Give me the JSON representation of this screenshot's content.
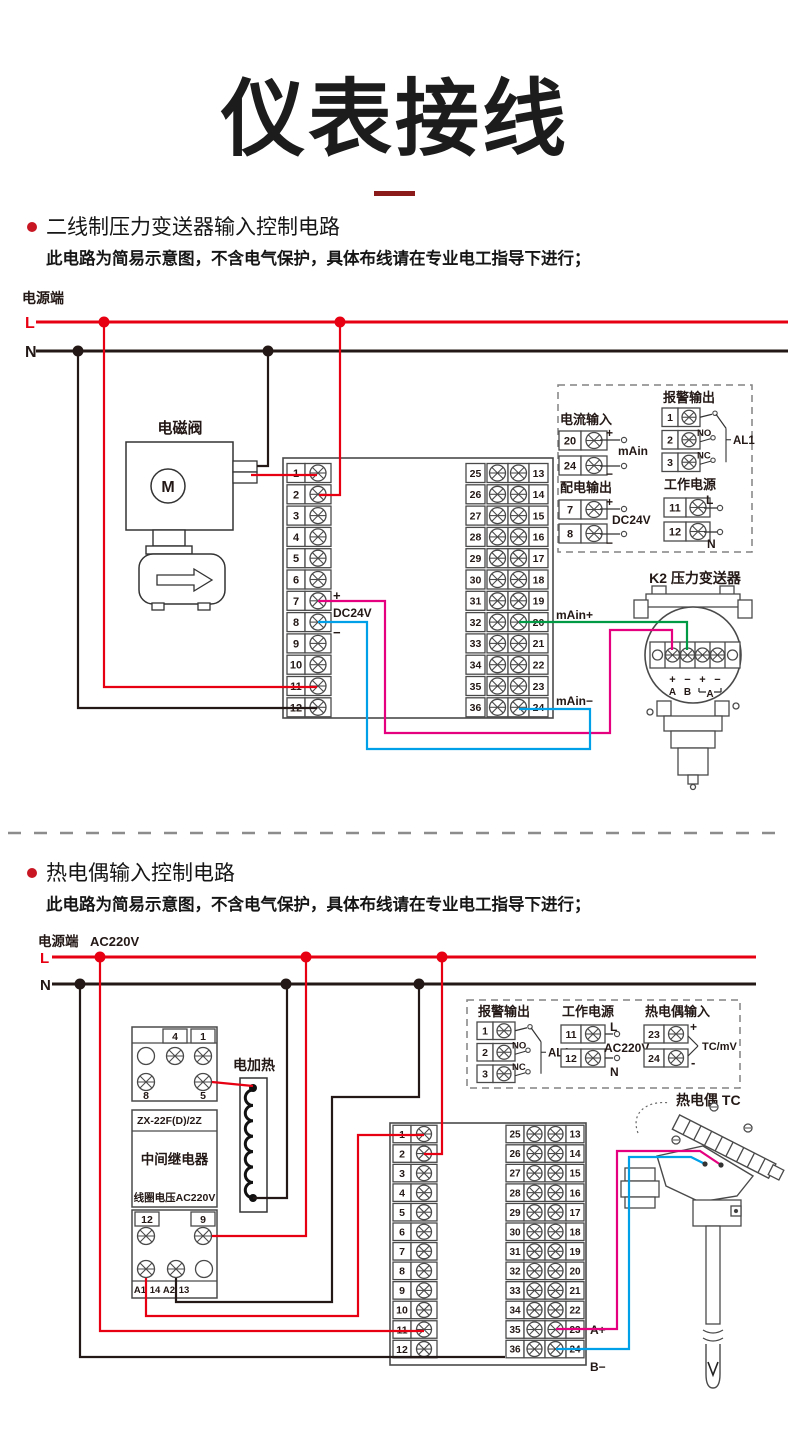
{
  "page": {
    "title": "仪表接线"
  },
  "colors": {
    "accent": "#8b1a1a",
    "bullet": "#c81623",
    "red": "#e60012",
    "black": "#231815",
    "magenta": "#e4007f",
    "blue": "#00a0e9",
    "green": "#009944",
    "gray": "#595757",
    "dash": "#8c8c8c"
  },
  "sections": [
    {
      "heading": "二线制压力变送器输入控制电路",
      "note": "此电路为简易示意图，不含电气保护，具体布线请在专业电工指导下进行；"
    },
    {
      "heading": "热电偶输入控制电路",
      "note": "此电路为简易示意图，不含电气保护，具体布线请在专业电工指导下进行；"
    }
  ],
  "diagram1": {
    "power_label": "电源端",
    "l": "L",
    "n": "N",
    "solenoid": {
      "label": "电磁阀",
      "motor": "M"
    },
    "block": {
      "left": [
        "1",
        "2",
        "3",
        "4",
        "5",
        "6",
        "7",
        "8",
        "9",
        "10",
        "11",
        "12"
      ],
      "mid": [
        "25",
        "26",
        "27",
        "28",
        "29",
        "30",
        "31",
        "32",
        "33",
        "34",
        "35",
        "36"
      ],
      "right": [
        "13",
        "14",
        "15",
        "16",
        "17",
        "18",
        "19",
        "20",
        "21",
        "22",
        "23",
        "24"
      ]
    },
    "block_labels": {
      "plus": "+",
      "dc24v": "DC24V",
      "minus": "−",
      "main_plus": "mAin+",
      "main_minus": "mAin−"
    },
    "legend": {
      "current_input": {
        "title": "电流输入",
        "terminals": [
          "20",
          "24"
        ],
        "plus": "+",
        "minus": "−",
        "label": "mAin"
      },
      "alarm_output": {
        "title": "报警输出",
        "terminals": [
          "1",
          "2",
          "3"
        ],
        "no": "NO",
        "nc": "NC",
        "label": "AL1"
      },
      "dist_output": {
        "title": "配电输出",
        "terminals": [
          "7",
          "8"
        ],
        "plus": "+",
        "minus": "−",
        "label": "DC24V"
      },
      "working_power": {
        "title": "工作电源",
        "terminals": [
          "11",
          "12"
        ],
        "l": "L",
        "n": "N"
      }
    },
    "transmitter": {
      "title": "K2 压力变送器",
      "signs": [
        "+",
        "−",
        "+",
        "−"
      ],
      "letters": [
        "A",
        "B",
        "A"
      ]
    }
  },
  "diagram2": {
    "power_label": "电源端",
    "voltage": "AC220V",
    "l": "L",
    "n": "N",
    "relay": {
      "model": "ZX-22F(D)/2Z",
      "name": "中间继电器",
      "coil": "线圈电压AC220V",
      "top_nums": [
        "4",
        "1"
      ],
      "mid_nums": [
        "8",
        "5"
      ],
      "low_nums": [
        "12",
        "9"
      ],
      "base_nums": [
        "A1",
        "14",
        "A2",
        "13"
      ]
    },
    "heater": {
      "label": "电加热"
    },
    "block": {
      "left": [
        "1",
        "2",
        "3",
        "4",
        "5",
        "6",
        "7",
        "8",
        "9",
        "10",
        "11",
        "12"
      ],
      "mid": [
        "25",
        "26",
        "27",
        "28",
        "29",
        "30",
        "31",
        "32",
        "33",
        "34",
        "35",
        "36"
      ],
      "right": [
        "13",
        "14",
        "15",
        "16",
        "17",
        "18",
        "19",
        "20",
        "21",
        "22",
        "23",
        "24"
      ]
    },
    "block_labels": {
      "a_plus": "A+",
      "b_minus": "B−"
    },
    "legend": {
      "alarm_output": {
        "title": "报警输出",
        "terminals": [
          "1",
          "2",
          "3"
        ],
        "no": "NO",
        "nc": "NC",
        "label": "AL1"
      },
      "working_power": {
        "title": "工作电源",
        "terminals": [
          "11",
          "12"
        ],
        "l": "L",
        "n": "N",
        "label": "AC220V"
      },
      "tc_input": {
        "title": "热电偶输入",
        "terminals": [
          "23",
          "24"
        ],
        "plus": "+",
        "minus": "-",
        "label": "TC/mV"
      }
    },
    "thermocouple": {
      "title": "热电偶 TC"
    }
  }
}
